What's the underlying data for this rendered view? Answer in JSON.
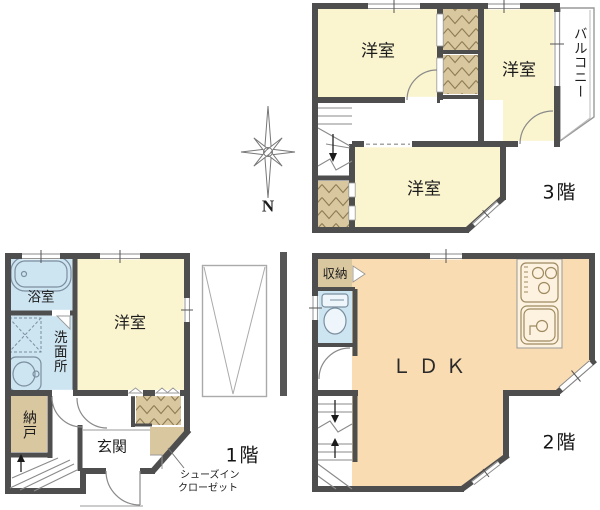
{
  "diagram_type": "japanese-house-floor-plan",
  "compass": {
    "north_label": "N"
  },
  "floor3": {
    "floor_label": "3階",
    "room_top_left": "洋室",
    "room_top_right": "洋室",
    "room_bottom": "洋室",
    "balcony": "バルコニー"
  },
  "floor2": {
    "floor_label": "2階",
    "ldk": "ＬＤＫ",
    "storage": "収納"
  },
  "floor1": {
    "floor_label": "1階",
    "bathroom": "浴室",
    "washroom": "洗面所",
    "western_room": "洋室",
    "storage_room": "納戸",
    "entrance": "玄関",
    "shoe_closet_line1": "シューズイン",
    "shoe_closet_line2": "クローゼット"
  },
  "colors": {
    "wall": "#4e4e4e",
    "room_yellow": "#faf4cf",
    "ldk_peach": "#fadcb2",
    "closet_tan": "#d9c7a0",
    "water_blue": "#cde4f1",
    "thin_line": "#8a8a8a"
  }
}
